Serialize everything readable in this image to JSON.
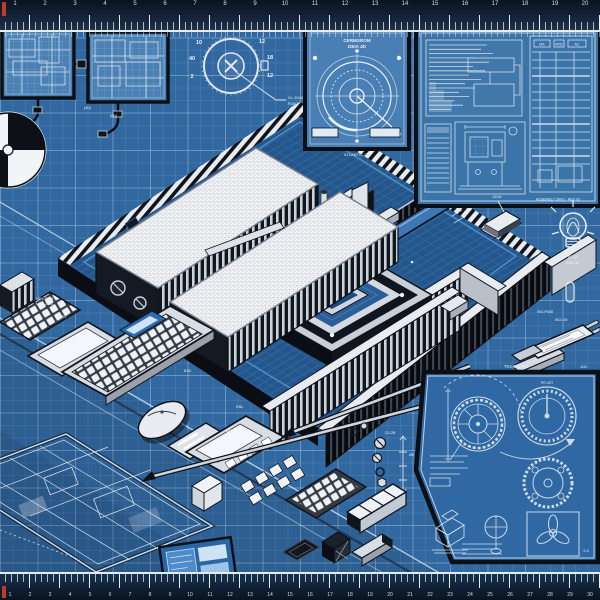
{
  "colors": {
    "background": "#31689f",
    "grid_line": "#7fa9cd",
    "ruler_dark": "#0b1624",
    "frame_dark": "#0b0f16",
    "line_white": "#e7eef6",
    "board_blue": "#24568c",
    "panel_light_blue": "#4a81b5",
    "silver": "#d8dde3",
    "accent_red": "#c2392b"
  },
  "rulers": {
    "top": [
      "1",
      "2",
      "3",
      "4",
      "5",
      "6",
      "7",
      "8",
      "9",
      "10",
      "11",
      "12",
      "13",
      "14",
      "15",
      "16",
      "17",
      "18",
      "19",
      "20"
    ],
    "bottom": [
      "1",
      "2",
      "3",
      "4",
      "5",
      "6",
      "7",
      "8",
      "9",
      "10",
      "11",
      "12",
      "13",
      "14",
      "15",
      "16",
      "17",
      "18",
      "19",
      "20",
      "21",
      "22",
      "23",
      "24",
      "25",
      "26",
      "27",
      "28",
      "29",
      "30"
    ]
  },
  "dial": {
    "numbers": [
      "2",
      "40",
      "10",
      "16",
      "18",
      "10",
      "12",
      "18",
      "12"
    ],
    "label_1": "XL-2040",
    "label_2": "R1609"
  },
  "gauge_panel": {
    "title_1": "CERMSROM",
    "title_2": "DEIA 4D",
    "badge_left": "A-19",
    "badge_right": "C-044",
    "caption": "ATLANTIC-CD"
  },
  "drawing_panel": {
    "header_left": "MA",
    "header_mid": "4051",
    "header_right": "AC",
    "caption": "ASSEMBLY DWG - REV 03"
  },
  "detail_panel": {
    "title": "T9-0912 P05",
    "side": "AXL",
    "dial_label": "PR-30T",
    "fan_label": "S-3"
  },
  "labels": {
    "wire_a": "(40)",
    "wire_b": "(00)",
    "part_left_1": "MFX-P208",
    "part_left_2": "MFD-2005",
    "angle": "1757",
    "kb": "618",
    "kbl": "KBL",
    "pad": "650",
    "chip": "4018",
    "screw_top": "CU-2B",
    "screw_dim": "Ø6",
    "bulb_1": "47 Q3",
    "bulb_2": "A06-4B",
    "usb": "ISO-19",
    "tag": "ISO-P008"
  }
}
